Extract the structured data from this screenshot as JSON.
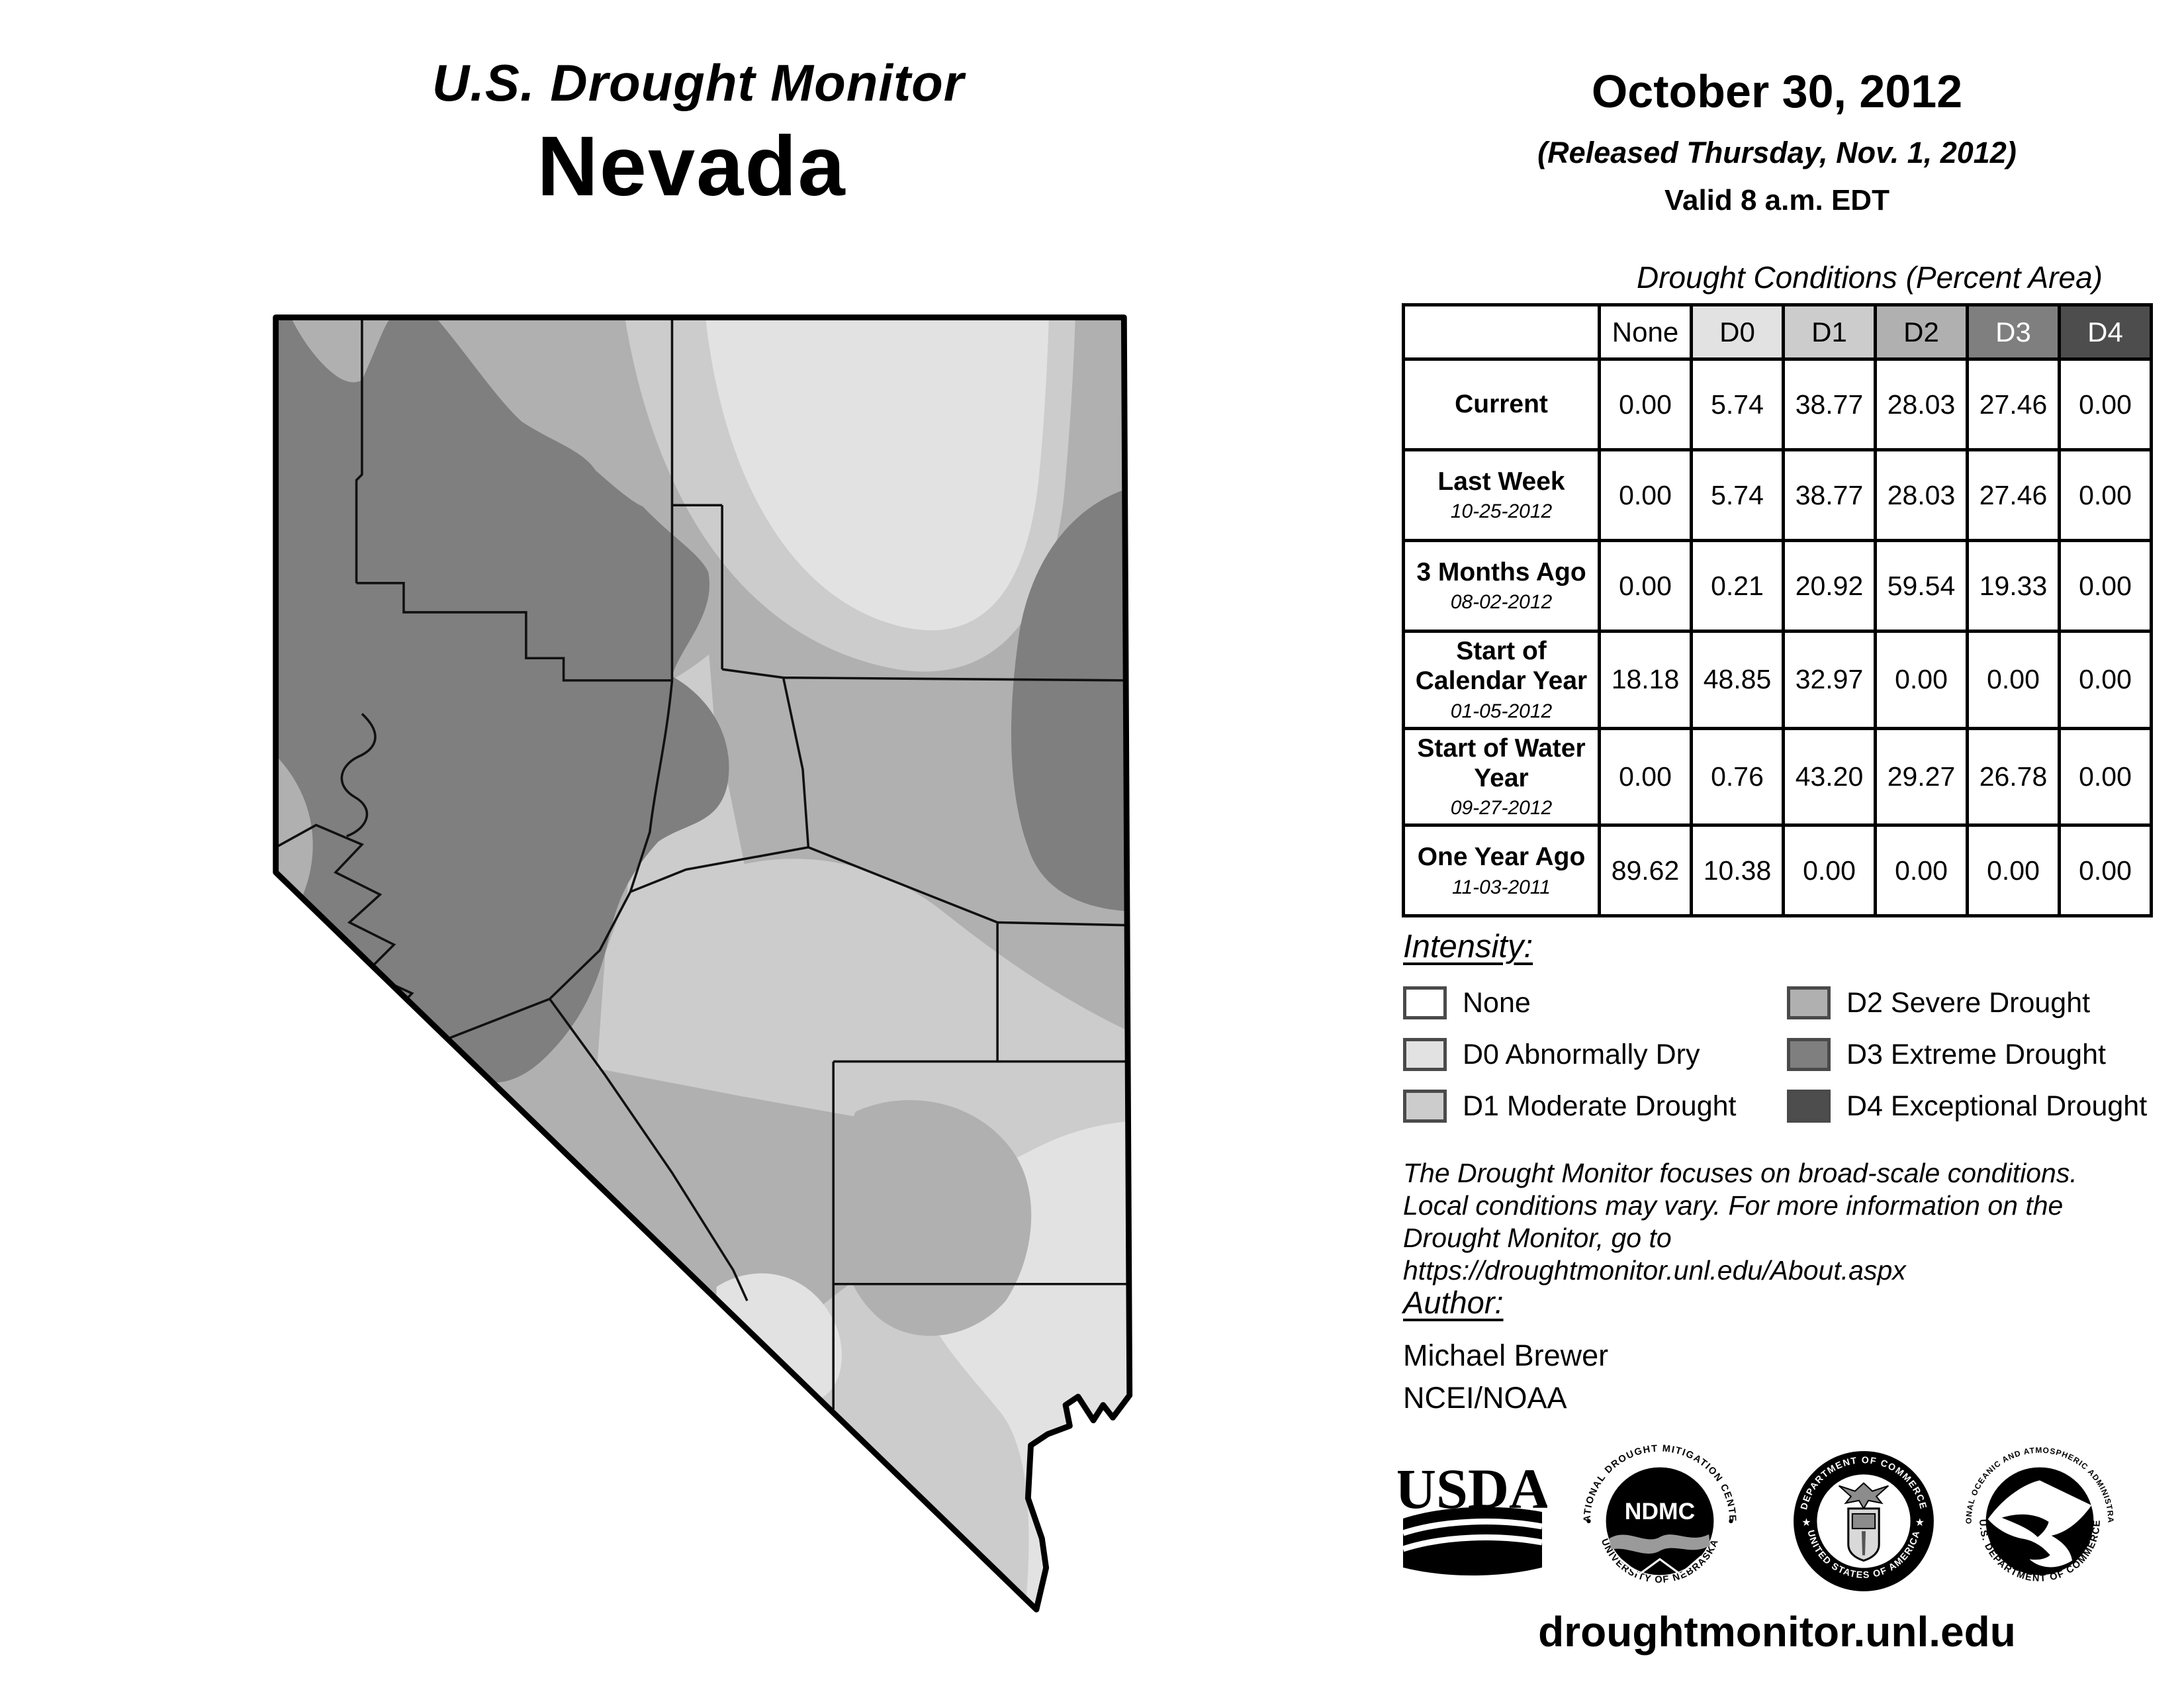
{
  "header": {
    "title_line1": "U.S. Drought Monitor",
    "title_line2": "Nevada",
    "date": "October 30, 2012",
    "released": "(Released Thursday, Nov. 1, 2012)",
    "valid": "Valid 8 a.m. EDT"
  },
  "table": {
    "title": "Drought Conditions (Percent Area)",
    "columns": [
      "None",
      "D0",
      "D1",
      "D2",
      "D3",
      "D4"
    ],
    "column_colors": [
      "#ffffff",
      "#e2e2e2",
      "#cccccc",
      "#b0b0b0",
      "#7f7f7f",
      "#4d4d4d"
    ],
    "rows": [
      {
        "label": "Current",
        "date": "",
        "values": [
          "0.00",
          "5.74",
          "38.77",
          "28.03",
          "27.46",
          "0.00"
        ]
      },
      {
        "label": "Last Week",
        "date": "10-25-2012",
        "values": [
          "0.00",
          "5.74",
          "38.77",
          "28.03",
          "27.46",
          "0.00"
        ]
      },
      {
        "label": "3 Months Ago",
        "date": "08-02-2012",
        "values": [
          "0.00",
          "0.21",
          "20.92",
          "59.54",
          "19.33",
          "0.00"
        ]
      },
      {
        "label": "Start of Calendar Year",
        "date": "01-05-2012",
        "values": [
          "18.18",
          "48.85",
          "32.97",
          "0.00",
          "0.00",
          "0.00"
        ]
      },
      {
        "label": "Start of Water Year",
        "date": "09-27-2012",
        "values": [
          "0.00",
          "0.76",
          "43.20",
          "29.27",
          "26.78",
          "0.00"
        ]
      },
      {
        "label": "One Year Ago",
        "date": "11-03-2011",
        "values": [
          "89.62",
          "10.38",
          "0.00",
          "0.00",
          "0.00",
          "0.00"
        ]
      }
    ]
  },
  "legend": {
    "heading": "Intensity:",
    "items": [
      {
        "label": "None",
        "color": "#ffffff"
      },
      {
        "label": "D0 Abnormally Dry",
        "color": "#e2e2e2"
      },
      {
        "label": "D1 Moderate Drought",
        "color": "#cccccc"
      },
      {
        "label": "D2 Severe Drought",
        "color": "#b0b0b0"
      },
      {
        "label": "D3 Extreme Drought",
        "color": "#7f7f7f"
      },
      {
        "label": "D4 Exceptional Drought",
        "color": "#4d4d4d"
      }
    ]
  },
  "disclaimer": {
    "line1": "The Drought Monitor focuses on broad-scale conditions.",
    "line2": "Local conditions may vary. For more information on the",
    "line3": "Drought Monitor, go to https://droughtmonitor.unl.edu/About.aspx"
  },
  "author": {
    "heading": "Author:",
    "name": "Michael Brewer",
    "org": "NCEI/NOAA"
  },
  "footer": {
    "url": "droughtmonitor.unl.edu"
  },
  "logos": {
    "usda": {
      "text": "USDA"
    },
    "ndmc": {
      "arc_top": "NATIONAL DROUGHT MITIGATION CENTER",
      "arc_bottom": "UNIVERSITY OF NEBRASKA",
      "center": "NDMC"
    },
    "doc": {
      "arc_top": "DEPARTMENT OF COMMERCE",
      "arc_bottom": "UNITED STATES OF AMERICA"
    },
    "noaa": {
      "arc_top": "NATIONAL OCEANIC AND ATMOSPHERIC ADMINISTRATION",
      "arc_bottom": "U.S. DEPARTMENT OF COMMERCE",
      "center": "NOAA"
    }
  },
  "map": {
    "state": "Nevada",
    "description": "Grayscale drought intensity shading by region with county boundaries"
  }
}
